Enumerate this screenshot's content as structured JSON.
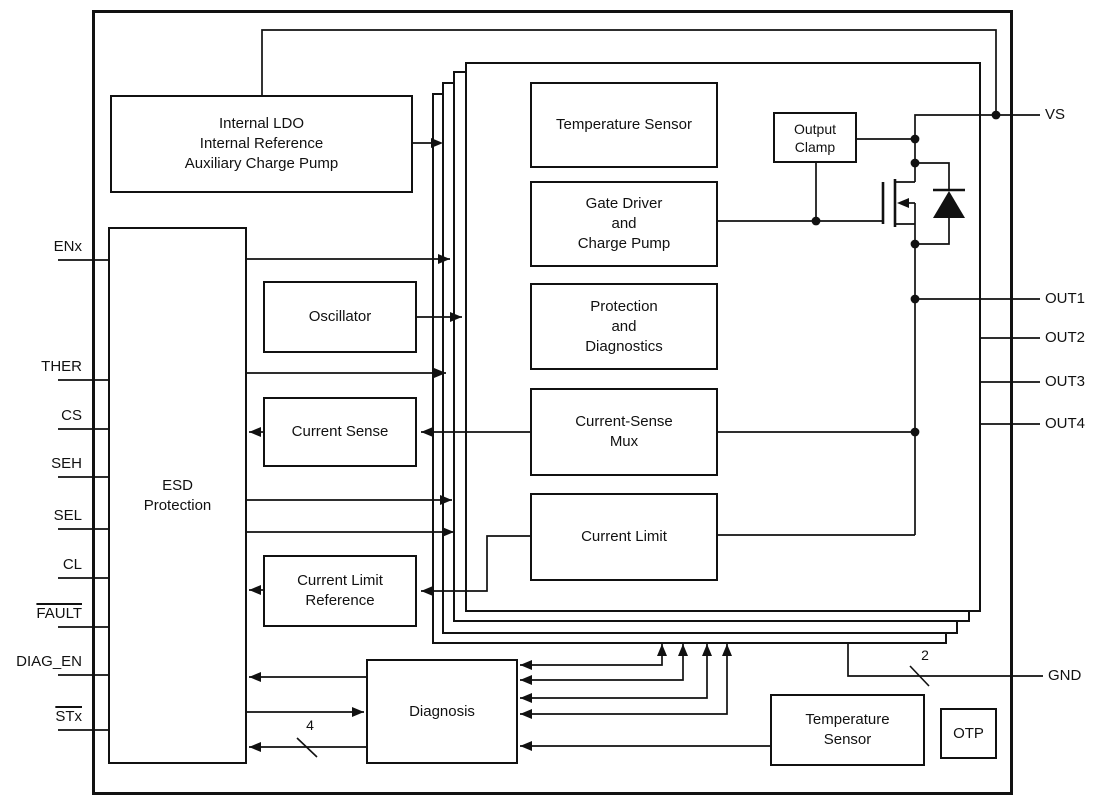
{
  "blocks": {
    "internal_ldo": {
      "text": "Internal LDO\nInternal Reference\nAuxiliary Charge Pump"
    },
    "esd": {
      "text": "ESD\nProtection"
    },
    "oscillator": {
      "label": "Oscillator"
    },
    "current_sense": {
      "label": "Current Sense"
    },
    "current_limit_reference": {
      "text": "Current Limit\nReference"
    },
    "diagnosis": {
      "label": "Diagnosis"
    },
    "temperature_sensor_bottom": {
      "text": "Temperature\nSensor"
    },
    "otp": {
      "label": "OTP"
    },
    "channel": {
      "temperature_sensor": {
        "label": "Temperature Sensor"
      },
      "gate_driver": {
        "text": "Gate Driver\nand\nCharge Pump"
      },
      "protection_diagnostics": {
        "text": "Protection\nand\nDiagnostics"
      },
      "current_sense_mux": {
        "text": "Current-Sense\nMux"
      },
      "current_limit": {
        "label": "Current Limit"
      },
      "output_clamp": {
        "text": "Output\nClamp"
      }
    }
  },
  "pins": {
    "left": [
      {
        "label": "ENx",
        "active_low": false
      },
      {
        "label": "THER",
        "active_low": false
      },
      {
        "label": "CS",
        "active_low": false
      },
      {
        "label": "SEH",
        "active_low": false
      },
      {
        "label": "SEL",
        "active_low": false
      },
      {
        "label": "CL",
        "active_low": false
      },
      {
        "label": "FAULT",
        "active_low": true
      },
      {
        "label": "DIAG_EN",
        "active_low": false
      },
      {
        "label": "STx",
        "active_low": true
      }
    ],
    "right": [
      {
        "label": "VS"
      },
      {
        "label": "OUT1"
      },
      {
        "label": "OUT2"
      },
      {
        "label": "OUT3"
      },
      {
        "label": "OUT4"
      },
      {
        "label": "GND"
      }
    ]
  },
  "bus": {
    "stx": "4",
    "gnd": "2"
  },
  "colors": {
    "ink": "#111111",
    "background": "#ffffff"
  }
}
